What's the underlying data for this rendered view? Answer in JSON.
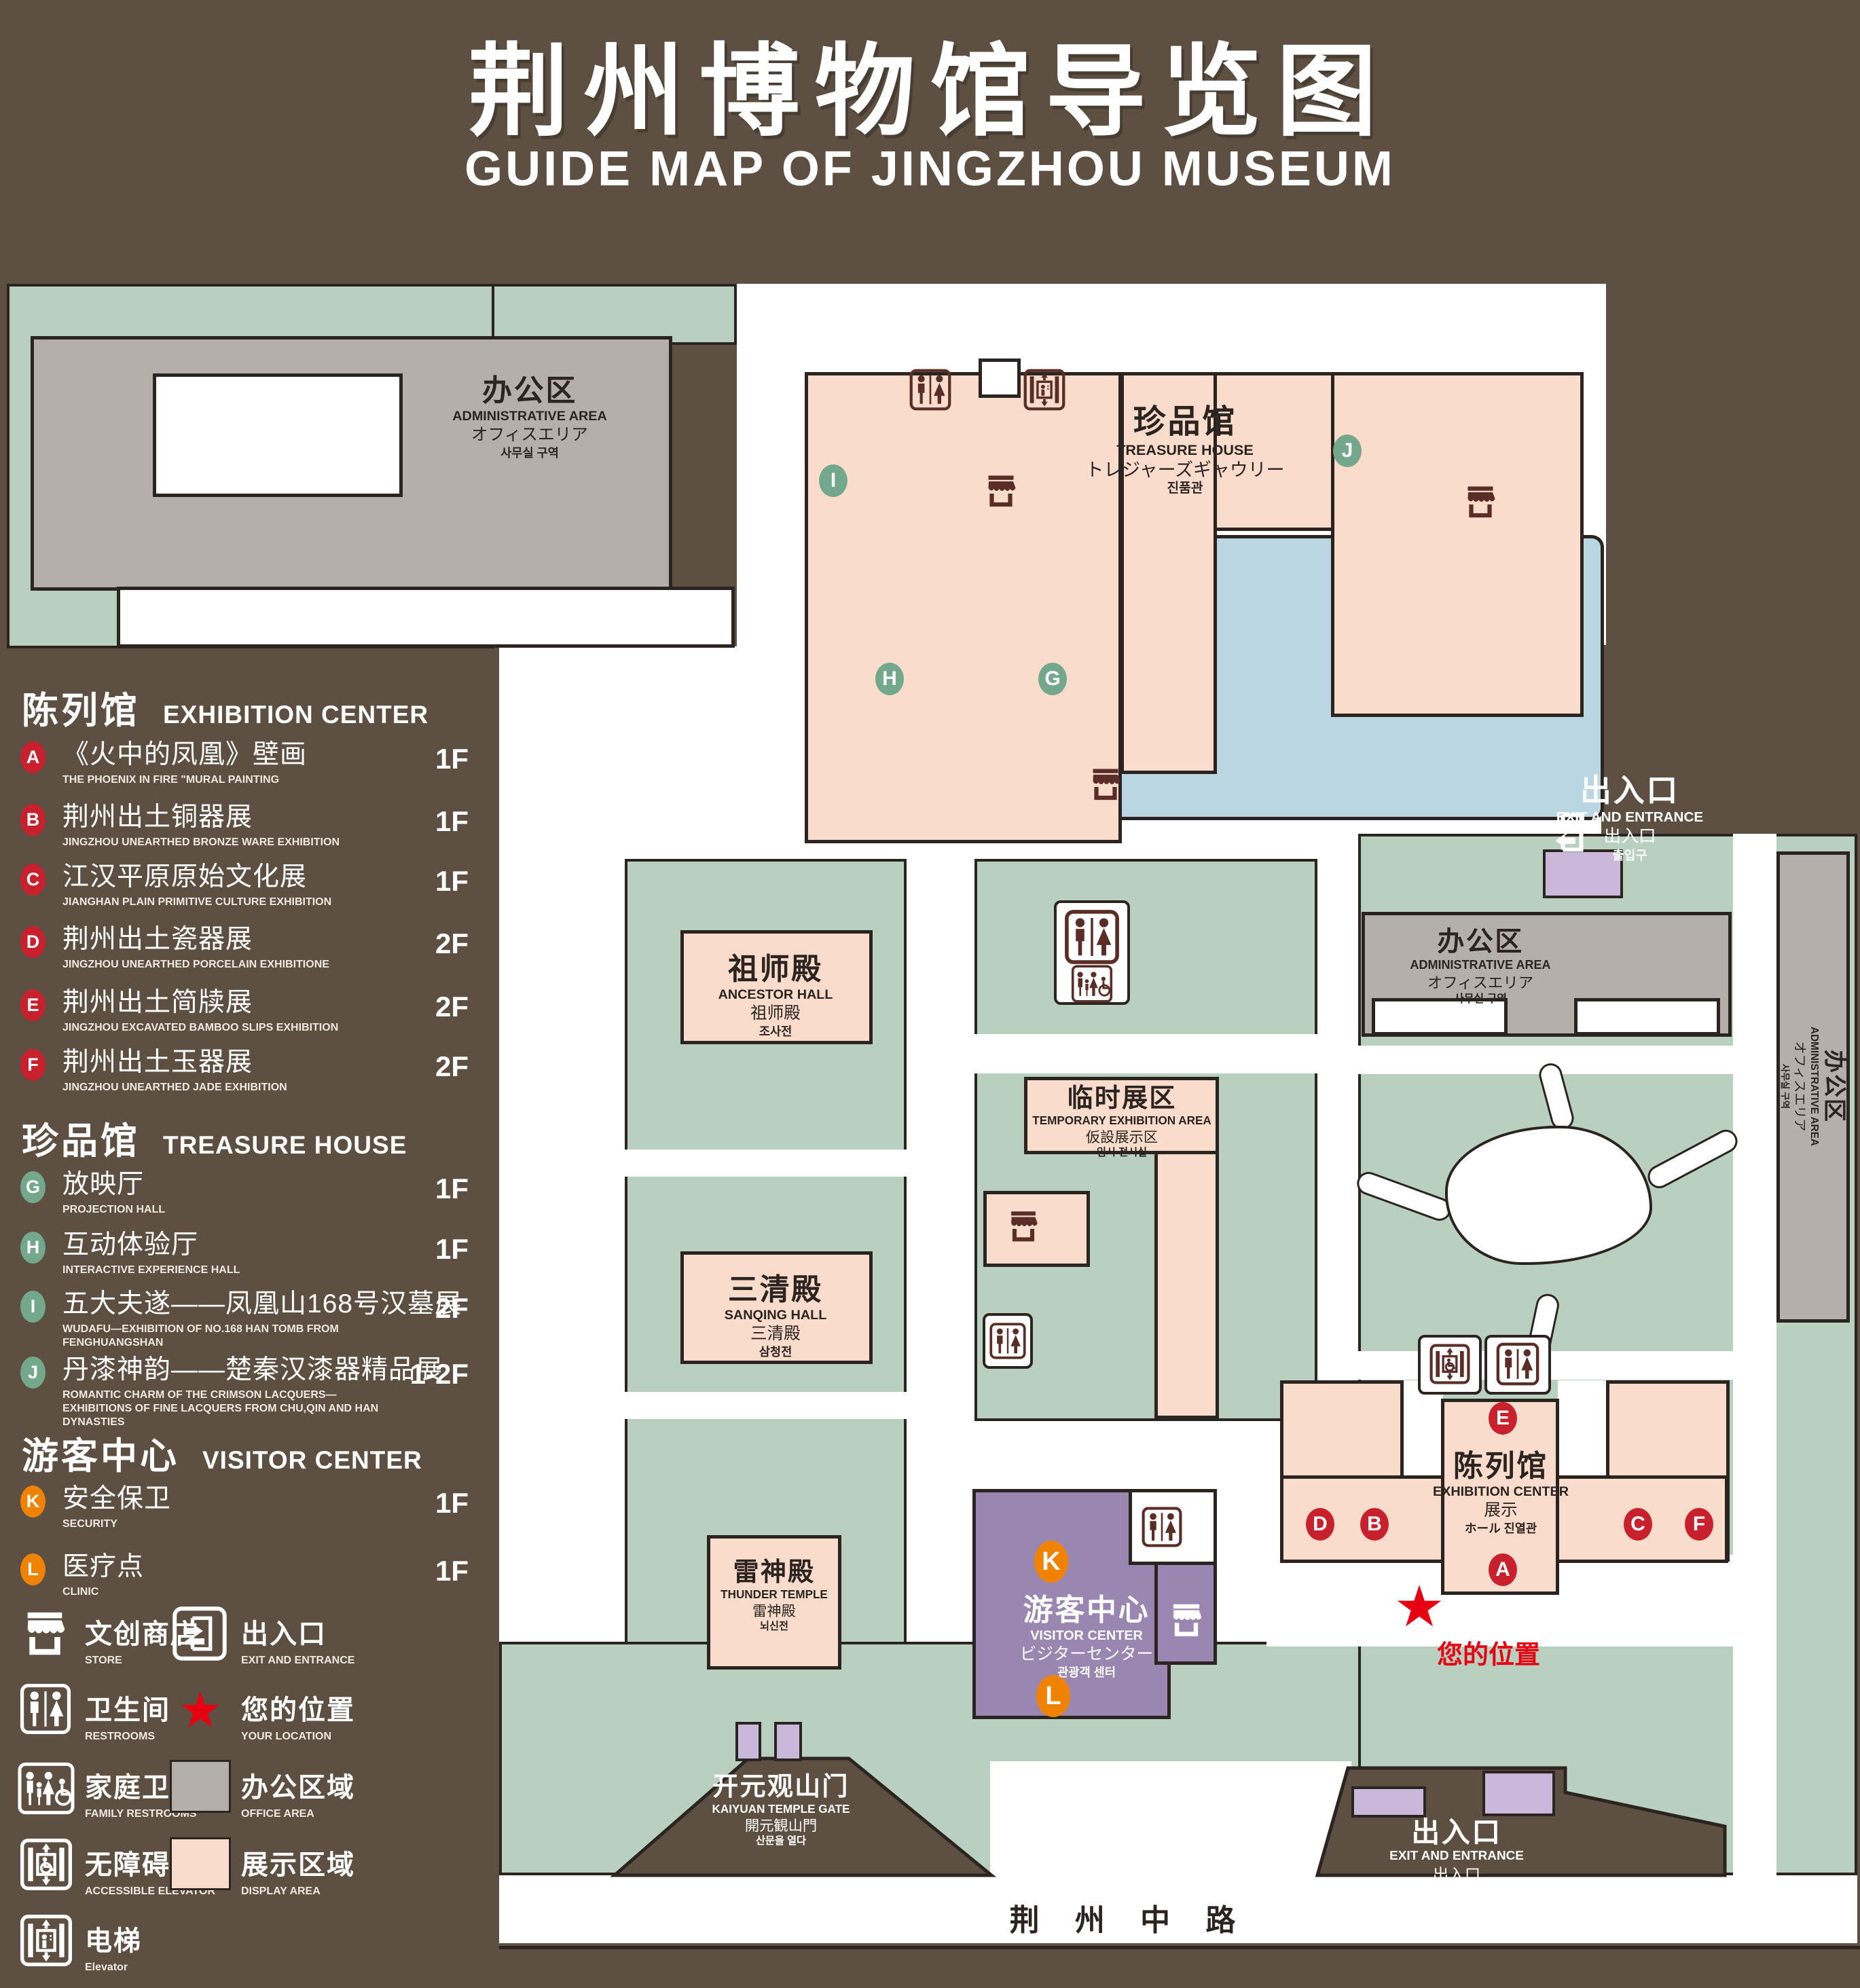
{
  "title": {
    "zh": "荆州博物馆导览图",
    "en": "GUIDE MAP OF JINGZHOU MUSEUM"
  },
  "colors": {
    "background": "#5d4f42",
    "lawn": "#b9d0c1",
    "display_area": "#f9dccb",
    "office_area": "#b4afab",
    "pond": "#b9d6e2",
    "visitor_center": "#9987b1",
    "entrance_pad": "#c9b8da",
    "marker_red": "#c9202e",
    "marker_green": "#74a88c",
    "marker_orange": "#ef8200",
    "location_red": "#e60012",
    "outline": "#2b2420"
  },
  "legend": {
    "sections": [
      {
        "zh": "陈列馆",
        "en": "EXHIBITION CENTER",
        "items": [
          {
            "letter": "A",
            "zh": "《火中的凤凰》壁画",
            "en": "THE PHOENIX IN FIRE \"MURAL PAINTING",
            "floor": "1F"
          },
          {
            "letter": "B",
            "zh": "荆州出土铜器展",
            "en": "JINGZHOU UNEARTHED BRONZE WARE EXHIBITION",
            "floor": "1F"
          },
          {
            "letter": "C",
            "zh": "江汉平原原始文化展",
            "en": "JIANGHAN PLAIN PRIMITIVE CULTURE EXHIBITION",
            "floor": "1F"
          },
          {
            "letter": "D",
            "zh": "荆州出土瓷器展",
            "en": "JINGZHOU UNEARTHED PORCELAIN EXHIBITIONE",
            "floor": "2F"
          },
          {
            "letter": "E",
            "zh": "荆州出土简牍展",
            "en": "JINGZHOU EXCAVATED BAMBOO SLIPS EXHIBITION",
            "floor": "2F"
          },
          {
            "letter": "F",
            "zh": "荆州出土玉器展",
            "en": "JINGZHOU UNEARTHED JADE EXHIBITION",
            "floor": "2F"
          }
        ]
      },
      {
        "zh": "珍品馆",
        "en": "TREASURE HOUSE",
        "items": [
          {
            "letter": "G",
            "zh": "放映厅",
            "en": "PROJECTION HALL",
            "floor": "1F"
          },
          {
            "letter": "H",
            "zh": "互动体验厅",
            "en": "INTERACTIVE EXPERIENCE HALL",
            "floor": "1F"
          },
          {
            "letter": "I",
            "zh": "五大夫遂——凤凰山168号汉墓展",
            "en": "WUDAFU—EXHIBITION OF NO.168 HAN TOMB FROM FENGHUANGSHAN",
            "floor": "2F"
          },
          {
            "letter": "J",
            "zh": "丹漆神韵——楚秦汉漆器精品展",
            "en": "ROMANTIC CHARM OF THE CRIMSON LACQUERS—EXHIBITIONS OF FINE LACQUERS FROM CHU,QIN AND HAN DYNASTIES",
            "floor": "1-2F"
          }
        ]
      },
      {
        "zh": "游客中心",
        "en": "VISITOR CENTER",
        "items": [
          {
            "letter": "K",
            "zh": "安全保卫",
            "en": "SECURITY",
            "floor": "1F"
          },
          {
            "letter": "L",
            "zh": "医疗点",
            "en": "CLINIC",
            "floor": "1F"
          }
        ]
      }
    ],
    "symbols": [
      {
        "icon": "store-icon",
        "zh": "文创商店",
        "en": "STORE"
      },
      {
        "icon": "exit-icon",
        "zh": "出入口",
        "en": "EXIT AND ENTRANCE"
      },
      {
        "icon": "restroom-icon",
        "zh": "卫生间",
        "en": "RESTROOMS"
      },
      {
        "icon": "location-star-icon",
        "z h": "",
        "zh": "您的位置",
        "en": "YOUR LOCATION"
      },
      {
        "icon": "family-restroom-icon",
        "zh": "家庭卫生间",
        "en": "FAMILY RESTROOMS"
      },
      {
        "icon": "office-area-swatch",
        "zh": "办公区域",
        "en": "OFFICE AREA"
      },
      {
        "icon": "accessible-elevator-icon",
        "zh": "无障碍电梯",
        "en": "ACCESSIBLE ELEVATOR"
      },
      {
        "icon": "display-area-swatch",
        "zh": "展示区域",
        "en": "DISPLAY AREA"
      },
      {
        "icon": "elevator-icon",
        "zh": "电梯",
        "en": "Elevator"
      }
    ]
  },
  "map": {
    "labels": {
      "admin": {
        "zh": "办公区",
        "en": "ADMINISTRATIVE AREA",
        "jp": "オフィスエリア",
        "kr": "사무실 구역"
      },
      "treasure": {
        "zh": "珍品馆",
        "en": "TREASURE HOUSE",
        "jp": "トレジャーズギャウリー",
        "kr": "진품관"
      },
      "ancestor": {
        "zh": "祖师殿",
        "en": "ANCESTOR HALL",
        "jp": "祖师殿",
        "kr": "조사전"
      },
      "temporary": {
        "zh": "临时展区",
        "en": "TEMPORARY EXHIBITION AREA",
        "jp": "仮設展示区",
        "kr": "임시 전시실"
      },
      "sanqing": {
        "zh": "三清殿",
        "en": "SANQING HALL",
        "jp": "三清殿",
        "kr": "삼청전"
      },
      "thunder": {
        "zh": "雷神殿",
        "en": "THUNDER TEMPLE",
        "jp": "雷神殿",
        "kr": "뇌신전"
      },
      "visitor": {
        "zh": "游客中心",
        "en": "VISITOR CENTER",
        "jp": "ビジターセンター",
        "kr": "관광객 센터"
      },
      "exhibition": {
        "zh": "陈列馆",
        "en": "EXHIBITION CENTER",
        "jp": "展示",
        "kr": "ホール 진열관"
      },
      "exit": {
        "zh": "出入口",
        "en": "EXIT AND ENTRANCE",
        "jp": "出入口",
        "kr": "출입구"
      },
      "gate": {
        "zh": "开元观山门",
        "en": "KAIYUAN TEMPLE GATE",
        "jp": "開元観山門",
        "kr": "산문을 열다"
      },
      "road": {
        "zh": "荆 州 中 路"
      },
      "your_location": {
        "zh": "您的位置"
      }
    },
    "markers": [
      {
        "letter": "I"
      },
      {
        "letter": "J"
      },
      {
        "letter": "H"
      },
      {
        "letter": "G"
      },
      {
        "letter": "E"
      },
      {
        "letter": "D"
      },
      {
        "letter": "B"
      },
      {
        "letter": "A"
      },
      {
        "letter": "C"
      },
      {
        "letter": "F"
      },
      {
        "letter": "K"
      },
      {
        "letter": "L"
      }
    ]
  }
}
